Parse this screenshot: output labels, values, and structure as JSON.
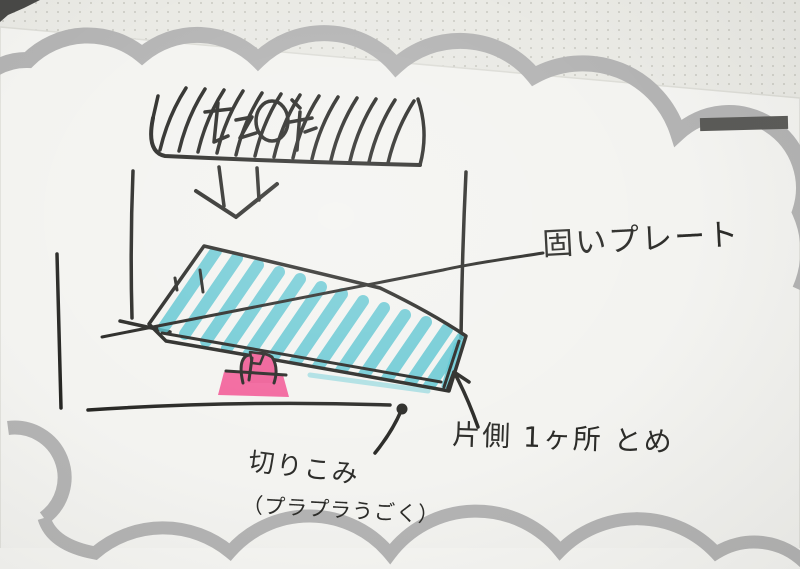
{
  "photo": {
    "type": "hand-drawn marker sketch on a white memo card with a gray cloud-scallop border, lying on dot-grid notepaper",
    "colors": {
      "dot_paper_bg": "#e9e9e4",
      "card_bg": "#f3f3f0",
      "cloud_border_gray": "#b3b3b3",
      "ink_black": "#262623",
      "plate_teal": "#55c3cf",
      "clip_pink": "#f2649c",
      "corner_bar_dark": "#5a5a57"
    }
  },
  "labels": {
    "hard_plate": "固いプレート",
    "one_side_fastening": "片側 1ヶ所 とめ",
    "cut_slit": "切りこみ",
    "flaps_loosely": "（プラプラうごく）"
  },
  "sketch_parts": {
    "hatched_bar": "hatched-fixed-bar-with-illegible-scribble",
    "down_arrow": "down-arrow",
    "plate": "teal-striped-plate-in-perspective",
    "pink_clip": "pink-clip-support",
    "fastening_dot": "black-fastening-dot"
  }
}
